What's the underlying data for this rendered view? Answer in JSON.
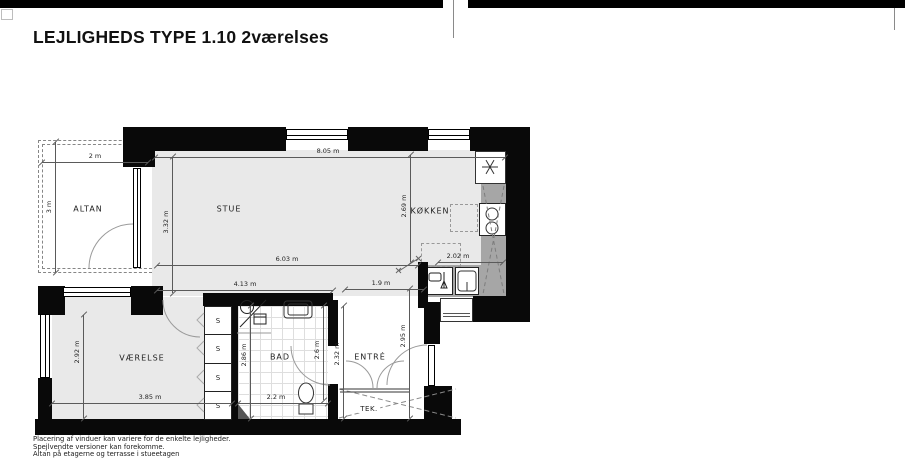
{
  "header": {
    "title": "LEJLIGHEDS TYPE 1.10 2værelses"
  },
  "footer": {
    "lines": [
      "Placering af vinduer kan variere for de enkelte lejligheder.",
      "Spejlvendte versioner kan forekomme.",
      "Altan på etagerne og terrasse i stueetagen"
    ]
  },
  "plan": {
    "rooms": {
      "altan": "ALTAN",
      "stue": "STUE",
      "kokken": "KØKKEN",
      "vaerelse": "VÆRELSE",
      "bad": "BAD",
      "entre": "ENTRÉ",
      "tek": "TEK."
    },
    "closet_label": "S",
    "dims": {
      "altan_width": "2 m",
      "altan_depth": "3 m",
      "stue_width_top": "8.05 m",
      "stue_depth": "3.32 m",
      "stue_width_mid": "6.03 m",
      "stue_width_lower": "4.13 m",
      "hall_width": "1.9 m",
      "kokken_depth": "2.69 m",
      "kokken_width": "2.02 m",
      "vaerelse_depth": "2.92 m",
      "vaerelse_width": "3.85 m",
      "bad_depth": "2.86 m",
      "bad_inner": "2.6 m",
      "bad_width": "2.2 m",
      "entre_depth_left": "2.32 m",
      "entre_depth_right": "2.95 m"
    },
    "icons": [
      "extractor-asterisk",
      "cooktop",
      "kitchen-sink",
      "dishwasher-faucet",
      "washing-machine",
      "hand-basin",
      "vanity-sink",
      "toilet",
      "tek-cross",
      "door-arcs"
    ],
    "colors": {
      "wall": "#090909",
      "floor": "#e9e9e9",
      "counter": "#a6a6a6"
    }
  }
}
